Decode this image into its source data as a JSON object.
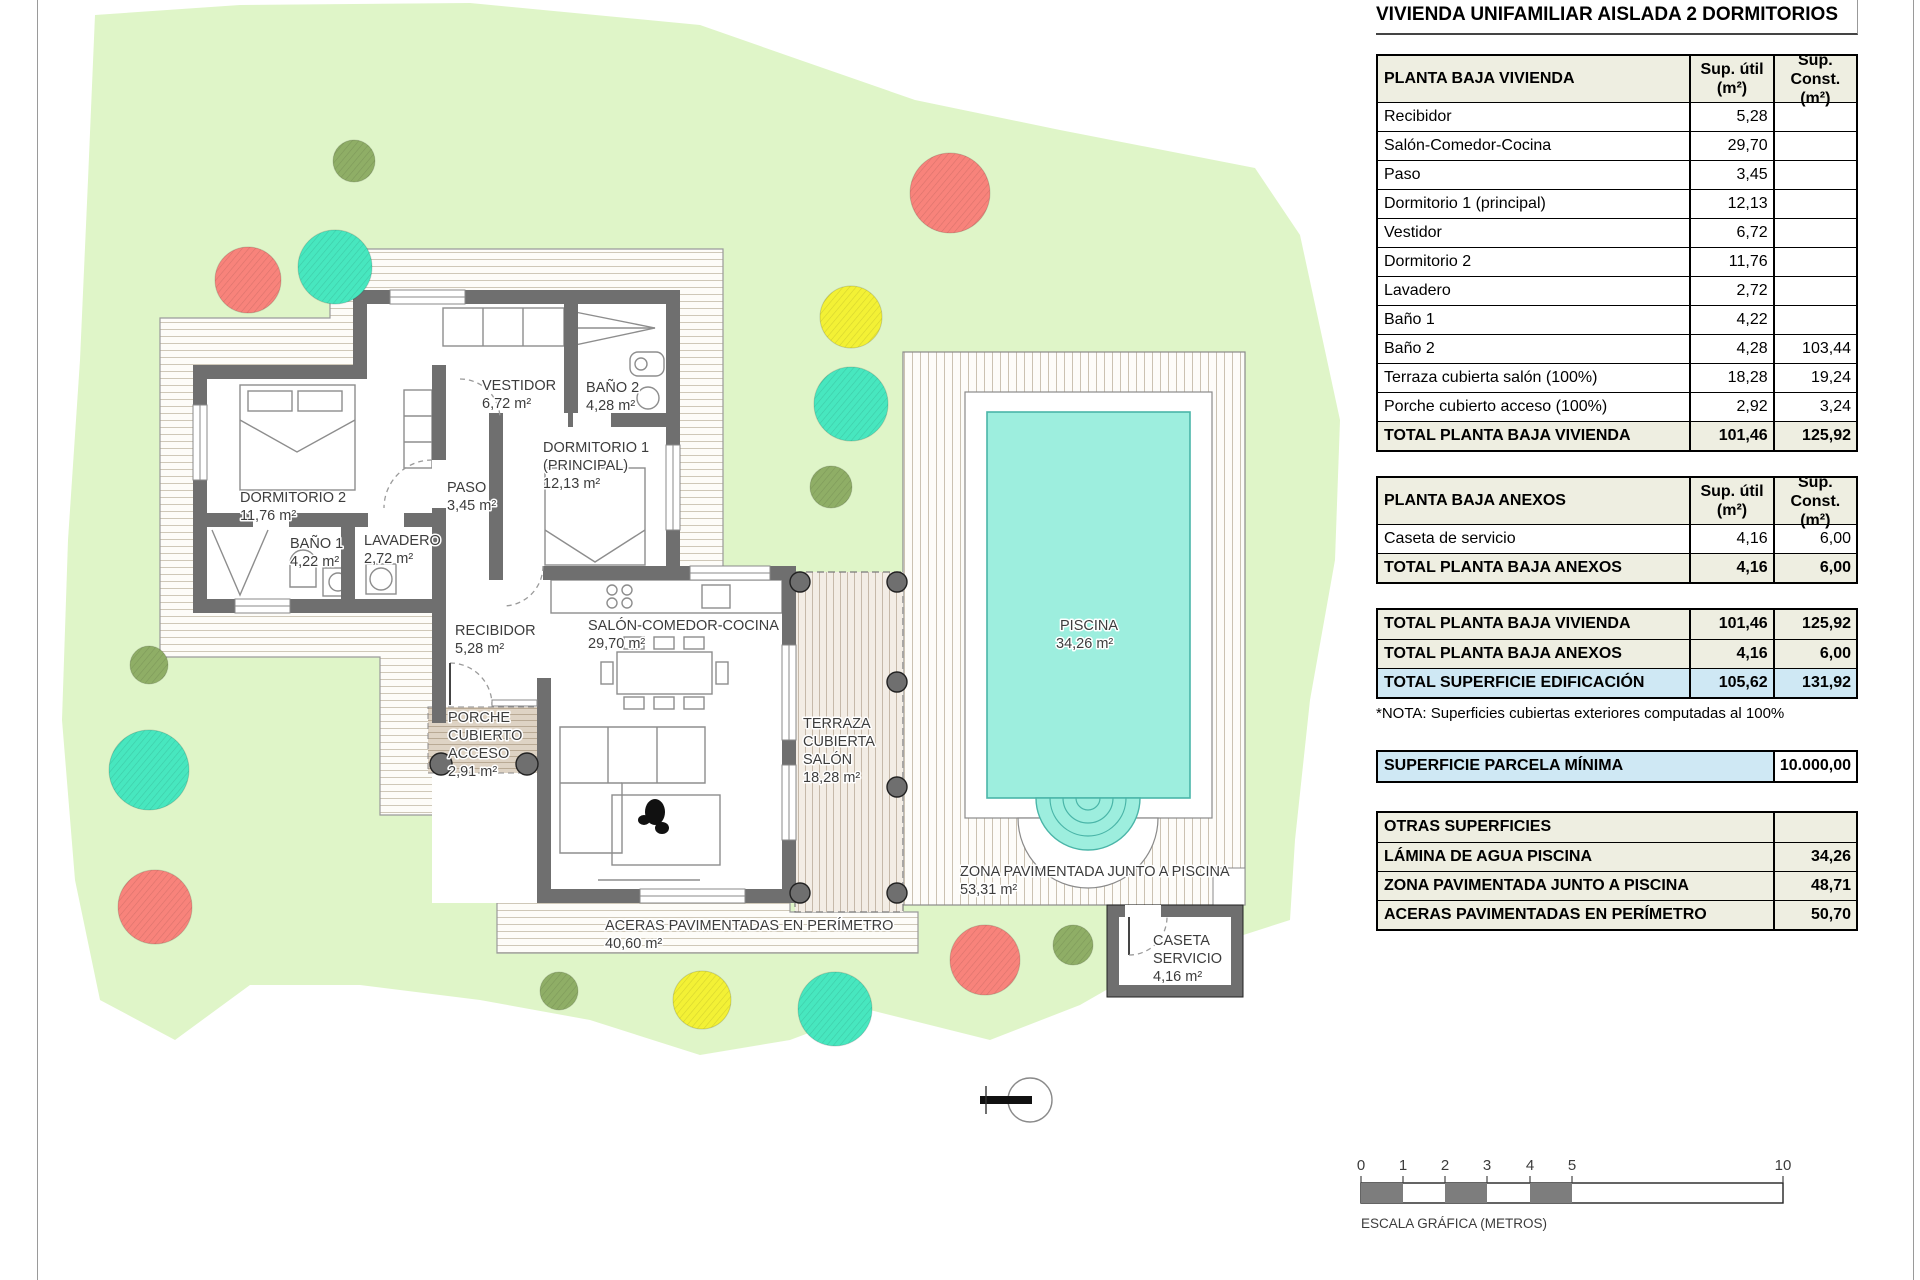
{
  "title": "VIVIENDA UNIFAMILIAR AISLADA 2 DORMITORIOS",
  "tables": {
    "vivienda": {
      "header": {
        "label": "PLANTA BAJA VIVIENDA",
        "col1": "Sup. útil (m²)",
        "col2": "Sup. Const. (m²)"
      },
      "rows": [
        {
          "label": "Recibidor",
          "util": "5,28",
          "const": ""
        },
        {
          "label": "Salón-Comedor-Cocina",
          "util": "29,70",
          "const": ""
        },
        {
          "label": "Paso",
          "util": "3,45",
          "const": ""
        },
        {
          "label": "Dormitorio 1 (principal)",
          "util": "12,13",
          "const": ""
        },
        {
          "label": "Vestidor",
          "util": "6,72",
          "const": ""
        },
        {
          "label": "Dormitorio 2",
          "util": "11,76",
          "const": ""
        },
        {
          "label": "Lavadero",
          "util": "2,72",
          "const": ""
        },
        {
          "label": "Baño 1",
          "util": "4,22",
          "const": ""
        },
        {
          "label": "Baño 2",
          "util": "4,28",
          "const": "103,44"
        },
        {
          "label": "Terraza cubierta salón (100%)",
          "util": "18,28",
          "const": "19,24"
        },
        {
          "label": "Porche cubierto acceso (100%)",
          "util": "2,92",
          "const": "3,24"
        }
      ],
      "total": {
        "label": "TOTAL PLANTA BAJA VIVIENDA",
        "util": "101,46",
        "const": "125,92"
      }
    },
    "anexos": {
      "header": {
        "label": "PLANTA BAJA ANEXOS",
        "col1": "Sup. útil (m²)",
        "col2": "Sup. Const. (m²)"
      },
      "rows": [
        {
          "label": "Caseta de servicio",
          "util": "4,16",
          "const": "6,00"
        }
      ],
      "total": {
        "label": "TOTAL PLANTA BAJA ANEXOS",
        "util": "4,16",
        "const": "6,00"
      }
    },
    "resumen": {
      "rows": [
        {
          "label": "TOTAL PLANTA BAJA VIVIENDA",
          "util": "101,46",
          "const": "125,92"
        },
        {
          "label": "TOTAL PLANTA BAJA ANEXOS",
          "util": "4,16",
          "const": "6,00"
        },
        {
          "label": "TOTAL SUPERFICIE EDIFICACIÓN",
          "util": "105,62",
          "const": "131,92"
        }
      ]
    },
    "nota": "*NOTA: Superficies cubiertas exteriores computadas al 100%",
    "parcela": {
      "label": "SUPERFICIE PARCELA MÍNIMA",
      "value": "10.000,00"
    },
    "otras": {
      "header": "OTRAS SUPERFICIES",
      "rows": [
        {
          "label": "LÁMINA DE AGUA PISCINA",
          "value": "34,26"
        },
        {
          "label": "ZONA PAVIMENTADA JUNTO A PISCINA",
          "value": "48,71"
        },
        {
          "label": "ACERAS PAVIMENTADAS EN PERÍMETRO",
          "value": "50,70"
        }
      ]
    }
  },
  "plan": {
    "labels": [
      {
        "lines": [
          "DORMITORIO 2"
        ],
        "area": "11,76 m²"
      },
      {
        "lines": [
          "PASO"
        ],
        "area": "3,45 m²"
      },
      {
        "lines": [
          "VESTIDOR"
        ],
        "area": "6,72 m²"
      },
      {
        "lines": [
          "BAÑO 2"
        ],
        "area": "4,28 m²"
      },
      {
        "lines": [
          "DORMITORIO 1",
          "(PRINCIPAL)"
        ],
        "area": "12,13 m²"
      },
      {
        "lines": [
          "BAÑO 1"
        ],
        "area": "4,22 m²"
      },
      {
        "lines": [
          "LAVADERO"
        ],
        "area": "2,72 m²"
      },
      {
        "lines": [
          "RECIBIDOR"
        ],
        "area": "5,28 m²"
      },
      {
        "lines": [
          "SALÓN-COMEDOR-COCINA"
        ],
        "area": "29,70 m²"
      },
      {
        "lines": [
          "PORCHE",
          "CUBIERTO",
          "ACCESO"
        ],
        "area": "2,91 m²"
      },
      {
        "lines": [
          "TERRAZA",
          "CUBIERTA",
          "SALÓN"
        ],
        "area": "18,28 m²"
      },
      {
        "lines": [
          "PISCINA"
        ],
        "area": "34,26 m²"
      },
      {
        "lines": [
          "ZONA PAVIMENTADA JUNTO A PISCINA"
        ],
        "area": "53,31 m²"
      },
      {
        "lines": [
          "ACERAS PAVIMENTADAS EN PERÍMETRO"
        ],
        "area": "40,60 m²"
      },
      {
        "lines": [
          "CASETA",
          "SERVICIO"
        ],
        "area": "4,16 m²"
      }
    ],
    "trees": [
      {
        "x": 354,
        "y": 161,
        "r": 21,
        "color": "#8fae66"
      },
      {
        "x": 248,
        "y": 280,
        "r": 33,
        "color": "#f8837b"
      },
      {
        "x": 335,
        "y": 267,
        "r": 37,
        "color": "#47e7bf"
      },
      {
        "x": 950,
        "y": 193,
        "r": 40,
        "color": "#f8837b"
      },
      {
        "x": 851,
        "y": 317,
        "r": 31,
        "color": "#f3f135"
      },
      {
        "x": 851,
        "y": 404,
        "r": 37,
        "color": "#47e7bf"
      },
      {
        "x": 831,
        "y": 487,
        "r": 21,
        "color": "#8fae66"
      },
      {
        "x": 149,
        "y": 665,
        "r": 19,
        "color": "#8fae66"
      },
      {
        "x": 149,
        "y": 770,
        "r": 40,
        "color": "#47e7bf"
      },
      {
        "x": 155,
        "y": 907,
        "r": 37,
        "color": "#f8837b"
      },
      {
        "x": 559,
        "y": 991,
        "r": 19,
        "color": "#8fae66"
      },
      {
        "x": 702,
        "y": 1000,
        "r": 29,
        "color": "#f3f135"
      },
      {
        "x": 835,
        "y": 1009,
        "r": 37,
        "color": "#47e7bf"
      },
      {
        "x": 985,
        "y": 960,
        "r": 35,
        "color": "#f8837b"
      },
      {
        "x": 1073,
        "y": 945,
        "r": 20,
        "color": "#8fae66"
      }
    ]
  },
  "scale_bar": {
    "ticks": [
      "0",
      "1",
      "2",
      "3",
      "4",
      "5",
      "10"
    ],
    "label": "ESCALA GRÁFICA (METROS)"
  },
  "colors": {
    "parcel": "#dff5c8",
    "wall": "#6f6f6f",
    "pool_water": "#9deede",
    "table_header": "#eeeee1",
    "highlight_blue": "#cfe8f4",
    "scale_dark": "#7d7d7d"
  }
}
